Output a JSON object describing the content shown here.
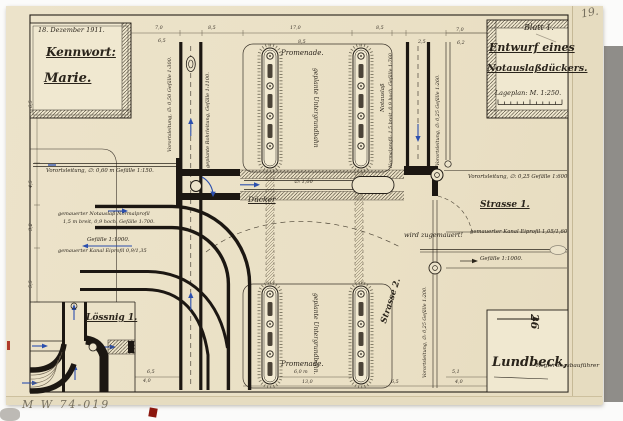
{
  "meta": {
    "page_number": "19.",
    "archive_number": "M W 74-019"
  },
  "title_block_left": {
    "date": "18. Dezember 1911.",
    "kennwort_label": "Kennwort:",
    "kennwort_value": "Marie."
  },
  "title_block_right": {
    "sheet": "Blatt 1.",
    "title_line1": "Entwurf eines",
    "title_line2": "Notauslaßdückers.",
    "scale_label": "Lageplan: M. 1:250."
  },
  "signature_block": {
    "name": "Lundbeck,",
    "role": "Regierungsbauführer",
    "stamp": "26"
  },
  "inset": {
    "title": "Lössnig 1."
  },
  "plan_labels": {
    "promenade_top": "Promenade.",
    "promenade_bottom": "Promenade.",
    "untergrundbahn_top": "geplante Untergrundbahn",
    "untergrundbahn_bottom": "geplante Untergrundbahn.",
    "duecker": "Dücker",
    "duecker_diameter": "∅: 1,00",
    "strasse_1": "Strasse 1.",
    "strasse_2": "Strasse 2.",
    "wird_zugemauert": "wird zugemauert!",
    "vorortsleitung_060": "Vorortsleitung, ∅: 0,60 m Gefälle 1:150.",
    "notauslass_line1": "gemauerter Notauslaß Normalprofil",
    "notauslass_line2": "1,5 m breit, 0,9 hoch, Gefälle 1:700.",
    "gefaelle_links": "Gefälle 1:1000.",
    "kanal_links": "gemauerter Kanal Eiprofil 0,9/1,35",
    "vorortsleitung_025_600": "Vorortsleitung, ∅: 0,25 Gefälle 1:600.",
    "kanal_rechts": "gemauerter Kanal Eiprofil 1,05/1,60",
    "gefaelle_rechts": "Gefälle 1:1000.",
    "vorortsleitung_050": "Vorortsleitung, ∅: 0,50 Gefälle 1:300.",
    "geplante_rohrleitung": "geplante Rohrleitung, Gefälle 1:1100.",
    "normalprofil": "Normalprofil: 1,5 breit, 0,9 hoch, Gefälle 1:760.",
    "notauslass_vertical": "Notauslaß",
    "vorortsleitung_025_260": "Vorortsleitung, ∅: 0,25 Gefälle 1:260.",
    "vorortsleitung_025_200": "Vorortsleitung, ∅: 0,25 Gefälle 1:200."
  },
  "dimensions": [
    "7,0",
    "6,5",
    "8,5",
    "17,0",
    "8,5",
    "8,5",
    "2,5",
    "7,0",
    "6,2",
    "6,5",
    "4,5",
    "3,2",
    "5,5",
    "6,5",
    "4,0",
    "6,0 m",
    "13,0",
    "6,5",
    "5,1",
    "4,0"
  ]
}
